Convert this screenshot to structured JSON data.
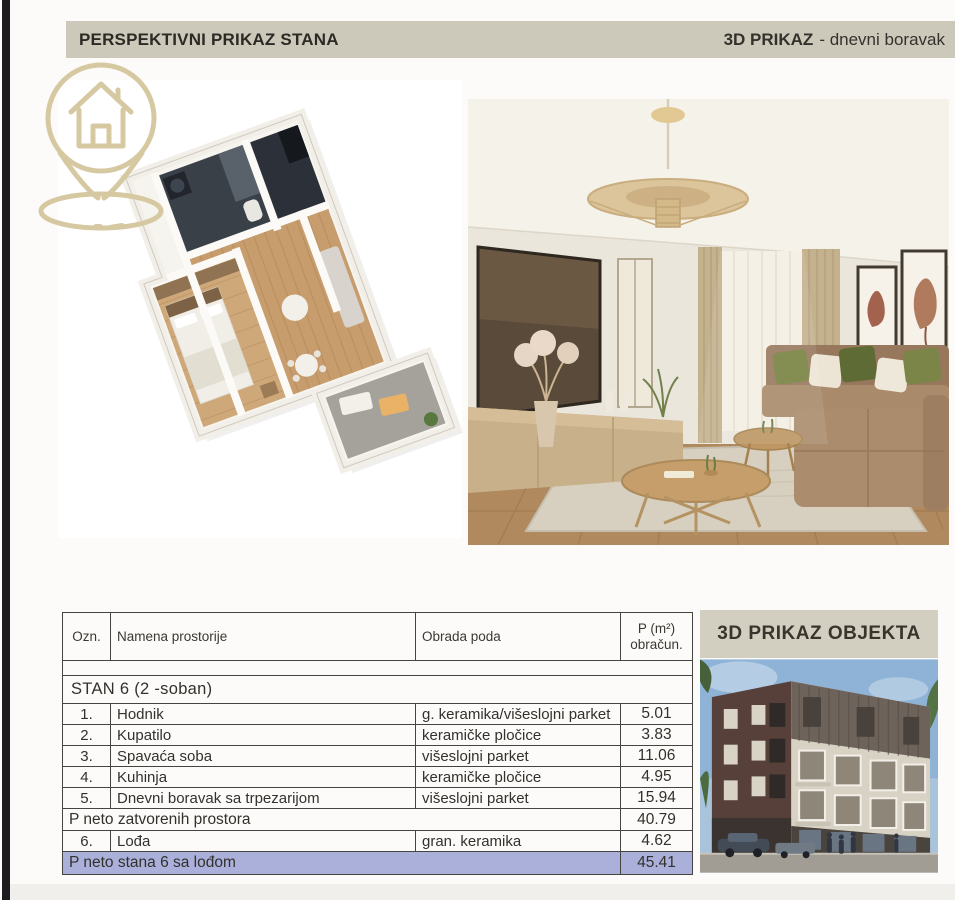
{
  "header": {
    "left_title": "PERSPEKTIVNI PRIKAZ STANA",
    "right_bold": "3D PRIKAZ",
    "right_rest": "- dnevni boravak"
  },
  "objekta": {
    "title": "3D PRIKAZ OBJEKTA"
  },
  "images": {
    "floorplan": "3D perspektivni prikaz stana (izometrijska osnova)",
    "living_room": "3D render dnevnog boravka",
    "building": "3D render stambenog objekta"
  },
  "table": {
    "columns": {
      "ozn": "Ozn.",
      "name": "Namena prostorije",
      "floor": "Obrada poda",
      "area_line1": "P (m²)",
      "area_line2": "obračun."
    },
    "section_title": "STAN 6  (2 -soban)",
    "rows": [
      {
        "ozn": "1.",
        "name": "Hodnik",
        "floor": "g. keramika/višeslojni parket",
        "area": "5.01"
      },
      {
        "ozn": "2.",
        "name": "Kupatilo",
        "floor": "keramičke pločice",
        "area": "3.83"
      },
      {
        "ozn": "3.",
        "name": "Spavaća soba",
        "floor": "višeslojni parket",
        "area": "11.06"
      },
      {
        "ozn": "4.",
        "name": "Kuhinja",
        "floor": "keramičke pločice",
        "area": "4.95"
      },
      {
        "ozn": "5.",
        "name": "Dnevni boravak sa trpezarijom",
        "floor": "višeslojni parket",
        "area": "15.94"
      }
    ],
    "subtotal": {
      "label": "P neto zatvorenih prostora",
      "area": "40.79"
    },
    "row6": {
      "ozn": "6.",
      "name": "Lođa",
      "floor": "gran. keramika",
      "area": "4.62"
    },
    "total": {
      "label": "P neto stana 6 sa lođom",
      "area": "45.41"
    }
  },
  "colors": {
    "header_bar_bg": "#cdc9ba",
    "panel_header_bg": "#d3cfc0",
    "total_row_bg": "#aab0da",
    "table_border": "#45443f",
    "logo_gold": "#d6c9a2",
    "text_dark": "#2b2a26"
  }
}
